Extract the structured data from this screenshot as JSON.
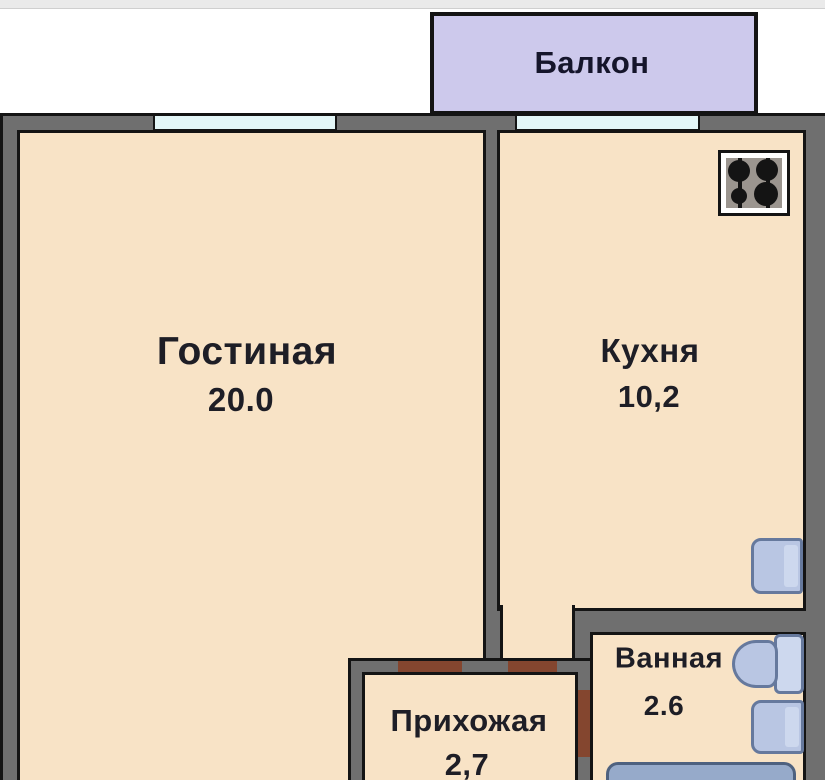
{
  "floor_plan": {
    "rooms": {
      "balcony": {
        "label": "Балкон"
      },
      "living_room": {
        "label": "Гостиная",
        "area": "20.0"
      },
      "kitchen": {
        "label": "Кухня",
        "area": "10,2"
      },
      "hallway": {
        "label": "Прихожая",
        "area": "2,7"
      },
      "bathroom": {
        "label": "Ванная",
        "area": "2.6"
      }
    },
    "fixtures": [
      "stove",
      "kitchen-sink",
      "toilet",
      "bathroom-sink",
      "bathtub"
    ],
    "doors": [
      "living-hallway",
      "kitchen-hallway",
      "hallway-bathroom"
    ],
    "windows": [
      "living-room-window",
      "kitchen-window"
    ]
  },
  "colors": {
    "outside": "#ffffff",
    "top_strip": "#eaeaea",
    "floor": "#f8e3c6",
    "wall": "#6f6f6f",
    "outline": "#141414",
    "balcony": "#cdc9ec",
    "window_glass": "#e3f6f7",
    "door": "#84462f",
    "fixture": "#b9c6e3",
    "fixture_border": "#66799d",
    "fixture_light": "#cdd8ee",
    "bathtub": "#96aaca",
    "bathtub_border": "#4e617f",
    "text": "#1e1e26"
  }
}
